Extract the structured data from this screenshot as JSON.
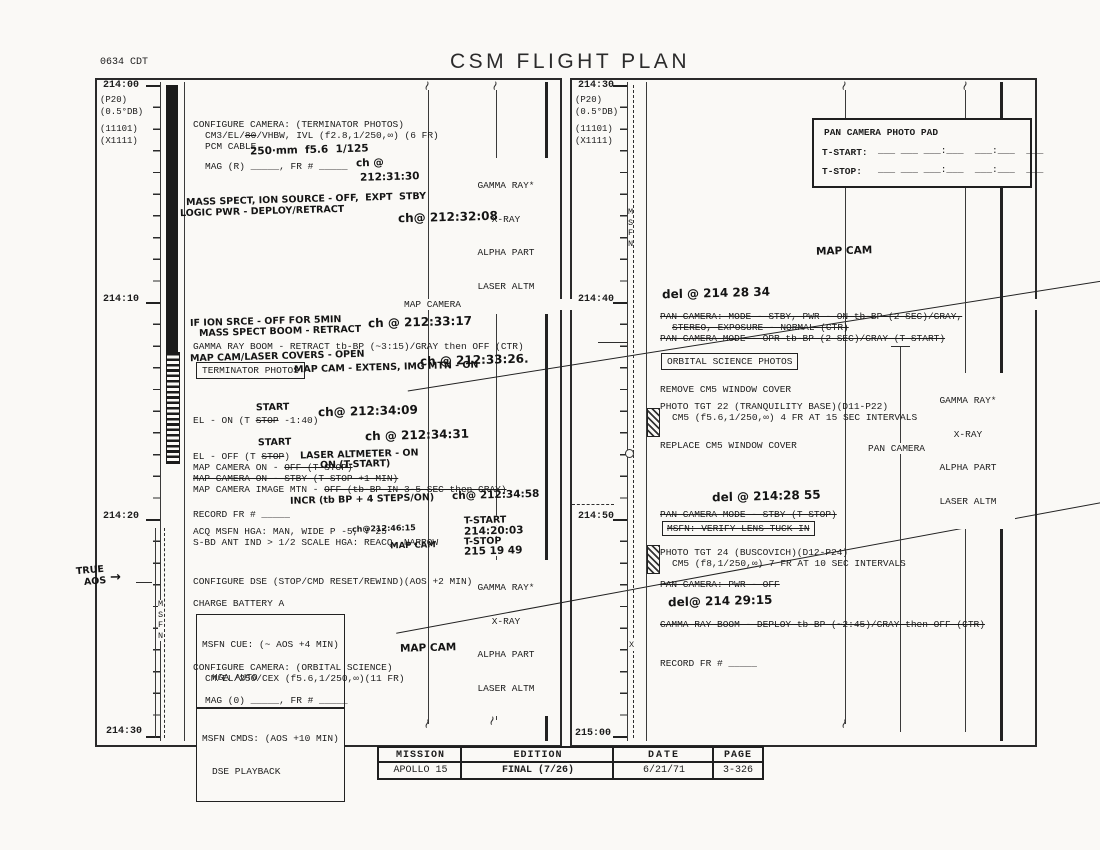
{
  "header": {
    "clock": "0634 CDT",
    "title": "CSM FLIGHT PLAN"
  },
  "footer": {
    "mission_label": "MISSION",
    "edition_label": "EDITION",
    "date_label": "DATE",
    "page_label": "PAGE",
    "mission": "APOLLO 15",
    "edition": "FINAL (7/26)",
    "date": "6/21/71",
    "page": "3-326"
  },
  "left": {
    "times": {
      "t0": "214:00",
      "t1": "214:10",
      "t2": "214:20",
      "t3": "214:30"
    },
    "params": [
      "(P20)",
      "(0.5°DB)",
      "(11101)",
      "(X1111)"
    ],
    "msfn": [
      "M",
      "S",
      "F",
      "N"
    ],
    "true_aos_1": "TRUE",
    "true_aos_2": "AOS",
    "arrow": "→",
    "map_camera_track": "MAP CAMERA",
    "experiments": {
      "l1": "GAMMA RAY*",
      "l2": "X-RAY",
      "l3": "ALPHA PART",
      "l4": "LASER ALTM"
    },
    "printed": {
      "cfg_term": "CONFIGURE CAMERA: (TERMINATOR PHOTOS)",
      "cam_pre": "CM3/EL/",
      "cam_struck": "80",
      "cam_post": "/VHBW, IVL (f2.8,1/250,∞) (6 FR)",
      "pcm": "PCM CABLE",
      "mag_r": "MAG (R) _____, FR # _____",
      "gamma_retract": "GAMMA RAY BOOM - RETRACT tb-BP (~3:15)/GRAY then OFF (CTR)",
      "term_photos": "TERMINATOR PHOTOS",
      "el_on_pre": "EL - ON (T ",
      "el_on_struck": "STOP",
      "el_on_post": " -1:40)",
      "el_off_pre": "EL - OFF (T ",
      "el_off_struck": "STOP",
      "el_off_post": ")",
      "mco_pre": "MAP CAMERA ON - ",
      "mco_struck": "OFF (T STOP)",
      "mc_stby": "MAP CAMERA ON - STBY (T STOP +1 MIN)",
      "mc_img_pre": "MAP CAMERA IMAGE MTN - ",
      "mc_img_struck": "OFF (tb-BP IN 3-5 SEC then GRAY)",
      "record_fr": "RECORD FR # _____",
      "acq": "ACQ MSFN HGA: MAN, WIDE P -5, Y 25",
      "sbd": "S-BD ANT IND > 1/2 SCALE HGA: REACQ, NARROW",
      "dse": "CONFIGURE DSE (STOP/CMD RESET/REWIND)(AOS +2 MIN)",
      "charge": "CHARGE BATTERY A",
      "msfn_cue1": "MSFN CUE: (~ AOS +4 MIN)",
      "msfn_cue2": "HGA AUTO",
      "cfg_orb": "CONFIGURE CAMERA: (ORBITAL SCIENCE)",
      "cm_el": "CM/EL/250/CEX (f5.6,1/250,∞)(11 FR)",
      "mag_0": "MAG (0) _____, FR # _____",
      "msfn_cmds1": "MSFN CMDS: (AOS +10 MIN)",
      "msfn_cmds2": "DSE PLAYBACK"
    },
    "hand": {
      "lens": "250·mm  f5.6  1/125",
      "ch1a": "ch @",
      "ch1b": "212:31:30",
      "mass1": "MASS SPECT, ION SOURCE - OFF,  EXPT  STBY",
      "mass2": "LOGIC PWR - DEPLOY/RETRACT",
      "ch2": "ch@ 212:32:08",
      "if1": "IF ION SRCE - OFF FOR 5MIN",
      "if2": "MASS SPECT BOOM - RETRACT",
      "ch3": "ch @ 212:33:17",
      "covers": "MAP CAM/LASER COVERS - OPEN",
      "ch4": "ch @ 212:33:26.",
      "extens": "MAP CAM - EXTENS, IMG MTN - ON",
      "start1": "START",
      "ch5": "ch@ 212:34:09",
      "start2": "START",
      "ch6": "ch @ 212:34:31",
      "laser_alt": "LASER ALTMETER - ON",
      "on_tstart": "ON (T-START)",
      "incr": "INCR (tb BP + 4 STEPS/ON)",
      "ch7": "ch@ 212:34:58",
      "mapcam_sm": "MAP CAM",
      "ch8": "ch@212:46:15",
      "tstart_lbl": "T-START",
      "tstart_val": "214:20:03",
      "tstop_lbl": "T-STOP",
      "tstop_val": "215 19 49",
      "mapcam2": "MAP CAM"
    }
  },
  "right": {
    "times": {
      "t0": "214:30",
      "t1": "214:40",
      "t2": "214:50",
      "t3": "215:00"
    },
    "params": [
      "(P20)",
      "(0.5°DB)",
      "(11101)",
      "(X1111)"
    ],
    "msfn": [
      "M",
      "S",
      "F",
      "N"
    ],
    "x_mark": "X",
    "photo_pad": {
      "title": "PAN CAMERA PHOTO PAD",
      "tstart_label": "T-START:",
      "tstart_blanks": "___ ___ ___:___  ___:___  ___",
      "tstop_label": "T-STOP:",
      "tstop_blanks": "___ ___ ___:___  ___:___  ___"
    },
    "experiments": {
      "l1": "GAMMA RAY*",
      "l2": "X-RAY",
      "l3": "ALPHA PART",
      "l4": "LASER ALTM"
    },
    "pan_camera_track": "PAN CAMERA",
    "printed": {
      "orb_photos": "ORBITAL SCIENCE PHOTOS",
      "remove": "REMOVE CM5 WINDOW COVER",
      "tgt22a": "PHOTO TGT 22 (TRANQUILITY BASE)(D11-P22)",
      "tgt22b": "CM5 (f5.6,1/250,∞) 4 FR AT 15 SEC INTERVALS",
      "replace": "REPLACE CM5 WINDOW COVER",
      "tgt24a": "PHOTO TGT 24 (BUSCOVICH)(D12-P24)",
      "tgt24b": "CM5 (f8,1/250,∞) 7 FR AT 10 SEC INTERVALS",
      "record_fr": "RECORD FR # _____"
    },
    "struck": {
      "pan1a": "PAN CAMERA: MODE - STBY, PWR - ON tb-BP (2 SEC)/GRAY,",
      "pan1b": "STEREO, EXPOSURE - NORMAL (CTR)",
      "pan2": "PAN CAMERA MODE - OPR tb-BP (2 SEC)/GRAY (T START)",
      "pan3": "PAN CAMERA MODE - STBY (T STOP)",
      "verify": "MSFN: VERIFY LENS TUCK IN",
      "pan4": "PAN CAMERA: PWR - OFF",
      "gamma_deploy": "GAMMA RAY BOOM - DEPLOY tb-BP (~2:45)/GRAY then OFF (CTR)"
    },
    "hand": {
      "mapcam": "MAP CAM",
      "del1": "del @ 214 28 34",
      "del2": "del @ 214:28 55",
      "del3": "del@ 214 29:15"
    }
  }
}
